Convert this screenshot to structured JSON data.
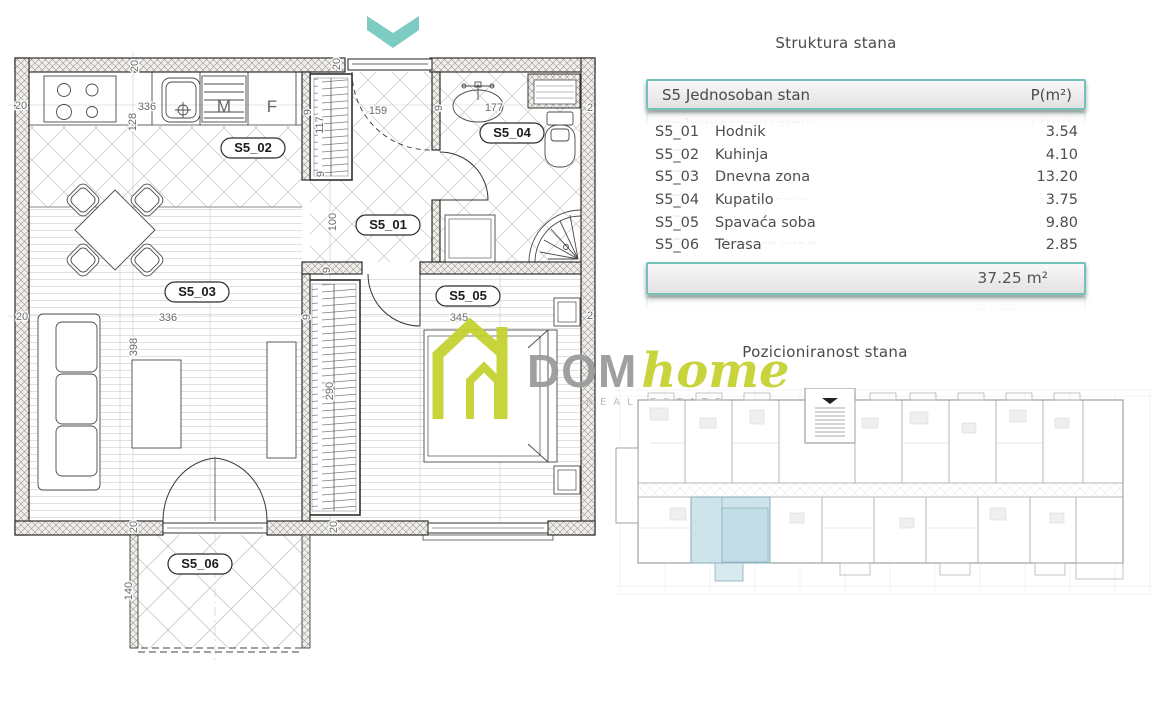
{
  "colors": {
    "teal_accent": "#72c2ba",
    "lime_logo": "#c6d232",
    "highlight_unit_blue": "#cfe4ea",
    "text_dark": "#4a4a4a"
  },
  "structure_table": {
    "title": "Struktura stana",
    "header": {
      "name": "S5 Jednosoban stan",
      "unit": "P(m²)"
    },
    "rows": [
      {
        "code": "S5_01",
        "name": "Hodnik",
        "area": "3.54"
      },
      {
        "code": "S5_02",
        "name": "Kuhinja",
        "area": "4.10"
      },
      {
        "code": "S5_03",
        "name": "Dnevna zona",
        "area": "13.20"
      },
      {
        "code": "S5_04",
        "name": "Kupatilo",
        "area": "3.75"
      },
      {
        "code": "S5_05",
        "name": "Spavaća soba",
        "area": "9.80"
      },
      {
        "code": "S5_06",
        "name": "Terasa",
        "area": "2.85"
      }
    ],
    "total": "37.25 m²"
  },
  "position_section": {
    "title": "Pozicioniranost stana"
  },
  "logo": {
    "dom": "DOM",
    "home": "home",
    "tagline": "REAL ESTATE"
  },
  "plan": {
    "rooms": {
      "s5_01": "S5_01",
      "s5_02": "S5_02",
      "s5_03": "S5_03",
      "s5_04": "S5_04",
      "s5_05": "S5_05",
      "s5_06": "S5_06"
    },
    "fixtures": {
      "washer": "M",
      "fridge": "F"
    },
    "dims": {
      "wall20_left_a": "20",
      "wall20_left_b": "20",
      "wall20_top_a": "20",
      "wall20_top_b": "20",
      "wall20_bottom_a": "20",
      "wall20_bottom_b": "20",
      "kitchen_336": "336",
      "kitchen_128": "128",
      "hall_159": "159",
      "hall_100": "100",
      "closet_117": "117",
      "bath_177": "177",
      "living_336": "336",
      "living_398": "398",
      "bed_345": "345",
      "bed_290": "290",
      "terrace_140": "140",
      "part9_a": "9",
      "part9_b": "9",
      "part9_c": "9",
      "part9_d": "9",
      "part9_e": "9",
      "edge2_a": "2",
      "edge2_b": "2"
    }
  }
}
